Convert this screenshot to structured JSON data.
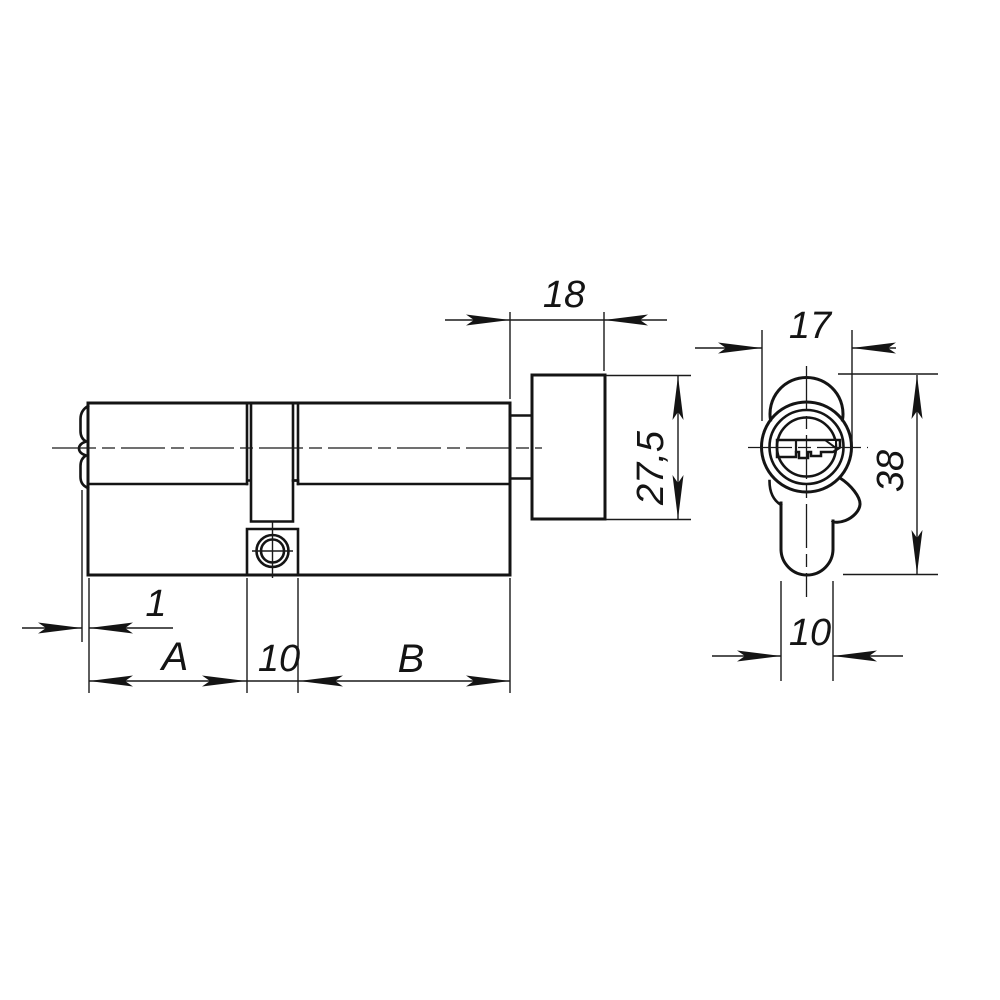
{
  "drawing": {
    "title": "Profile cylinder lock with thumbturn - dimensioned two-view drawing",
    "background_color": "#ffffff",
    "line_color": "#141414",
    "front_view": {
      "knob_depth": "18",
      "knob_diameter": "27,5",
      "face_lip": "1",
      "length_a": "A",
      "cam_gap_width": "10",
      "length_b": "B"
    },
    "side_view": {
      "body_diameter": "17",
      "total_height": "38",
      "body_width": "10"
    }
  }
}
